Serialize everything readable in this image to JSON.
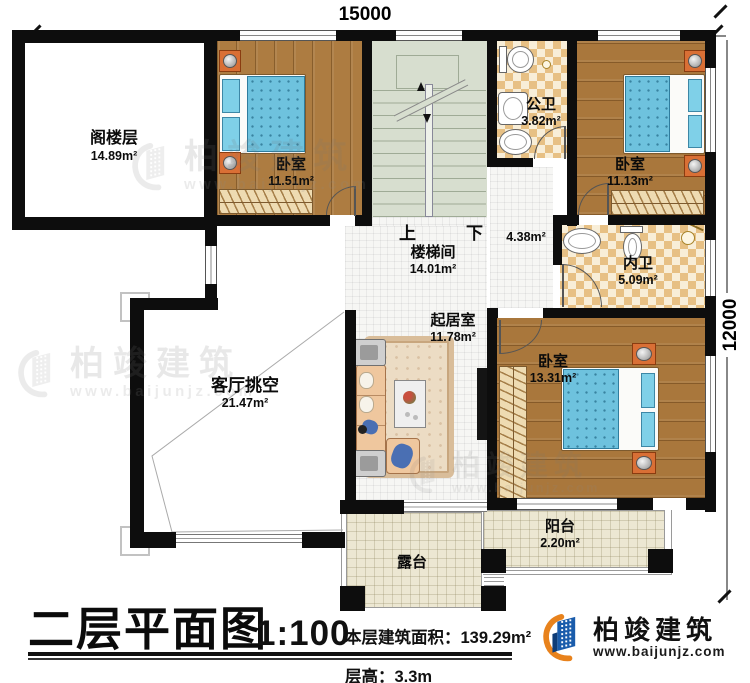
{
  "plan": {
    "dim_top": "15000",
    "dim_right": "12000",
    "stairs_up": "上",
    "stairs_down": "下",
    "hall_area": "4.38m²"
  },
  "rooms": {
    "attic": {
      "name": "阁楼层",
      "area": "14.89m²"
    },
    "bedroom_left": {
      "name": "卧室",
      "area": "11.51m²"
    },
    "public_bath": {
      "name": "公卫",
      "area": "3.82m²"
    },
    "bedroom_right": {
      "name": "卧室",
      "area": "11.13m²"
    },
    "stair_hall": {
      "name": "楼梯间",
      "area": "14.01m²"
    },
    "inner_bath": {
      "name": "内卫",
      "area": "5.09m²"
    },
    "family_room": {
      "name": "起居室",
      "area": "11.78m²"
    },
    "living_void": {
      "name": "客厅挑空",
      "area": "21.47m²"
    },
    "bedroom_south": {
      "name": "卧室",
      "area": "13.31m²"
    },
    "balcony": {
      "name": "阳台",
      "area": "2.20m²"
    },
    "terrace": {
      "name": "露台"
    }
  },
  "title_block": {
    "title": "二层平面图",
    "scale": "1:100",
    "floor_area": "本层建筑面积：139.29m²",
    "floor_height": "层高：3.3m"
  },
  "brand": {
    "name": "柏竣建筑",
    "website": "www.baijunjz.com"
  },
  "watermark": {
    "name": "柏竣建筑",
    "website": "www.baijunjz.com"
  },
  "colors": {
    "wall": "#0d0d0d",
    "wood_floor": "#ab7a40",
    "bath_tile": "#e7c084",
    "stair_floor": "#d7decf",
    "terrace_tile": "#ece7d2",
    "mattress_blue": "#6ec2de",
    "nightstand_orange": "#d96f35",
    "brand_blue": "#1a5cab",
    "brand_orange": "#e8821c"
  }
}
